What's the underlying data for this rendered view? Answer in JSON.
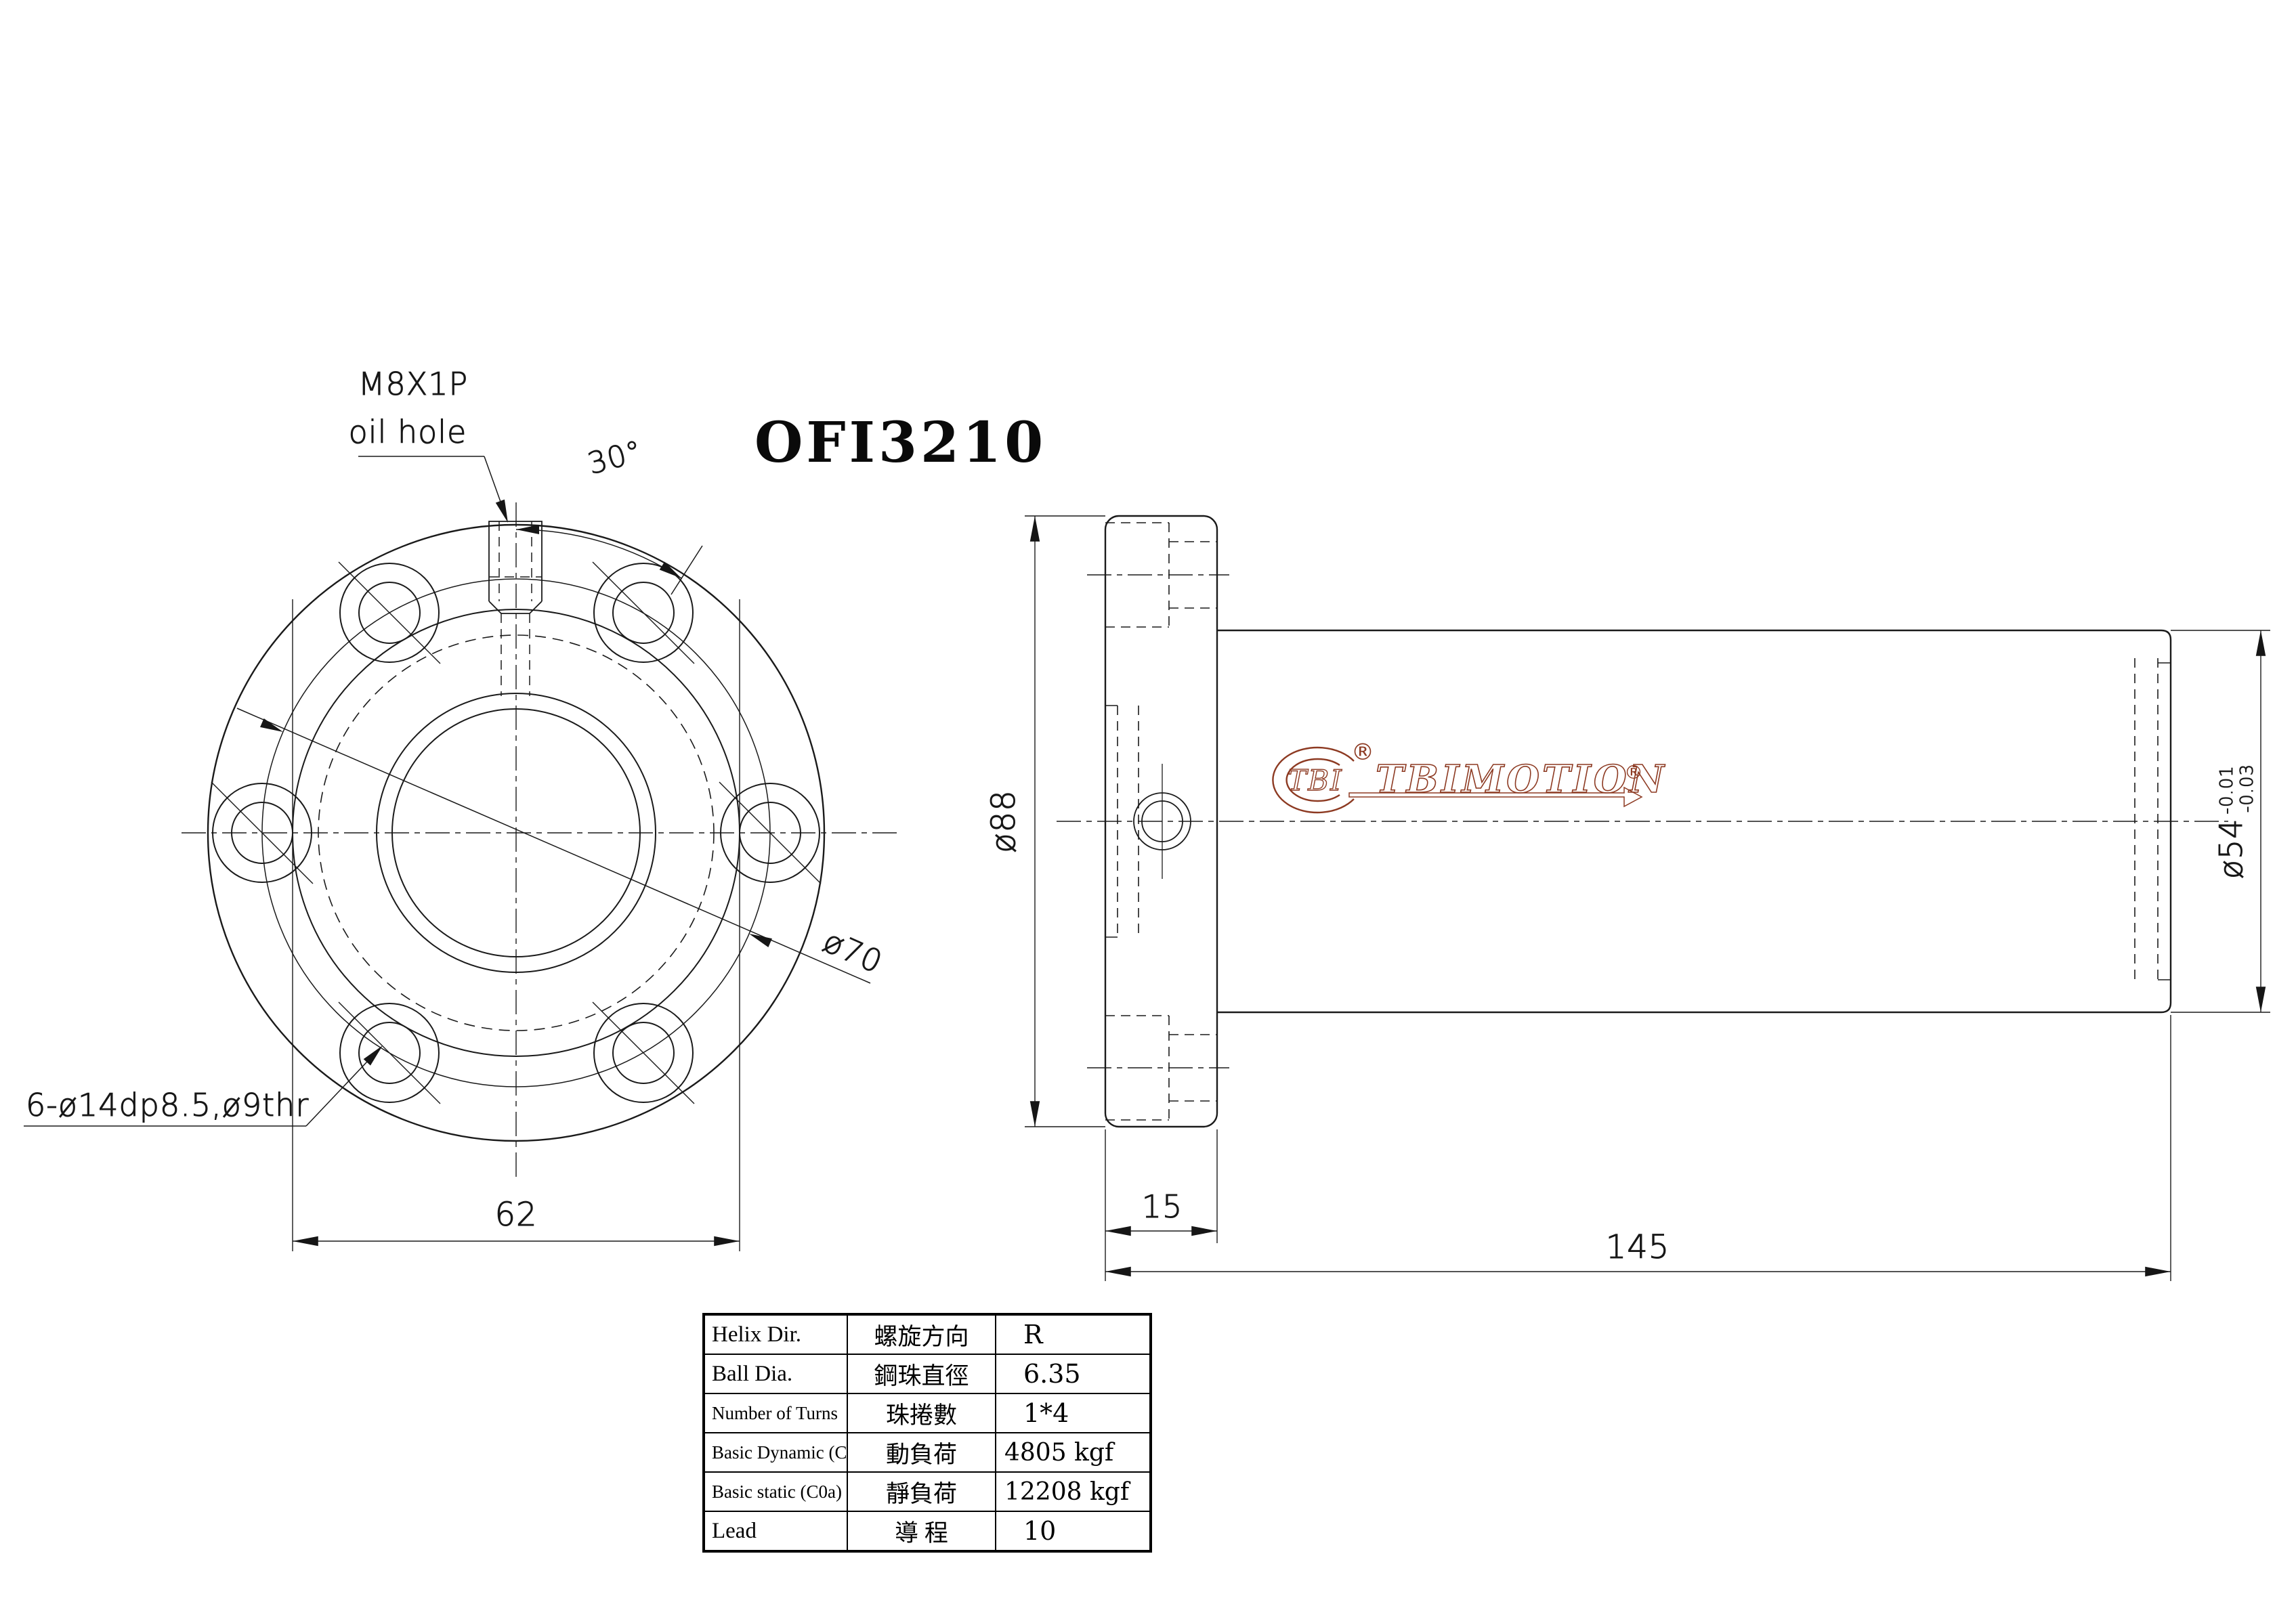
{
  "title": "OFI3210",
  "front_view": {
    "oil_hole_label_line1": "M8X1P",
    "oil_hole_label_line2": "oil hole",
    "angle_label": "30°",
    "bolt_circle_label": "ø70",
    "holes_label": "6-ø14dp8.5,ø9thr",
    "width_label": "62"
  },
  "side_view": {
    "flange_diameter_label": "ø88",
    "flange_thickness_label": "15",
    "total_length_label": "145",
    "body_diameter_label": "ø54",
    "body_tolerance_upper": "-0.01",
    "body_tolerance_lower": "-0.03"
  },
  "logo": {
    "tbi": "TBI",
    "tbimotion": "TBIMOTION",
    "registered": "®",
    "color": "#8d3a22"
  },
  "spec_table": {
    "rows": [
      {
        "en": "Helix  Dir.",
        "zh": "螺旋方向",
        "value": "R"
      },
      {
        "en": "Ball Dia.",
        "zh": "鋼珠直徑",
        "value": "6.35"
      },
      {
        "en": "Number of Turns",
        "zh": "珠捲數",
        "value": "1*4"
      },
      {
        "en": "Basic Dynamic (Ca)",
        "zh": "動負荷",
        "value": "4805 kgf"
      },
      {
        "en": "Basic static (C0a)",
        "zh": "靜負荷",
        "value": "12208 kgf"
      },
      {
        "en": "Lead",
        "zh": "導  程",
        "value": "10"
      }
    ]
  }
}
